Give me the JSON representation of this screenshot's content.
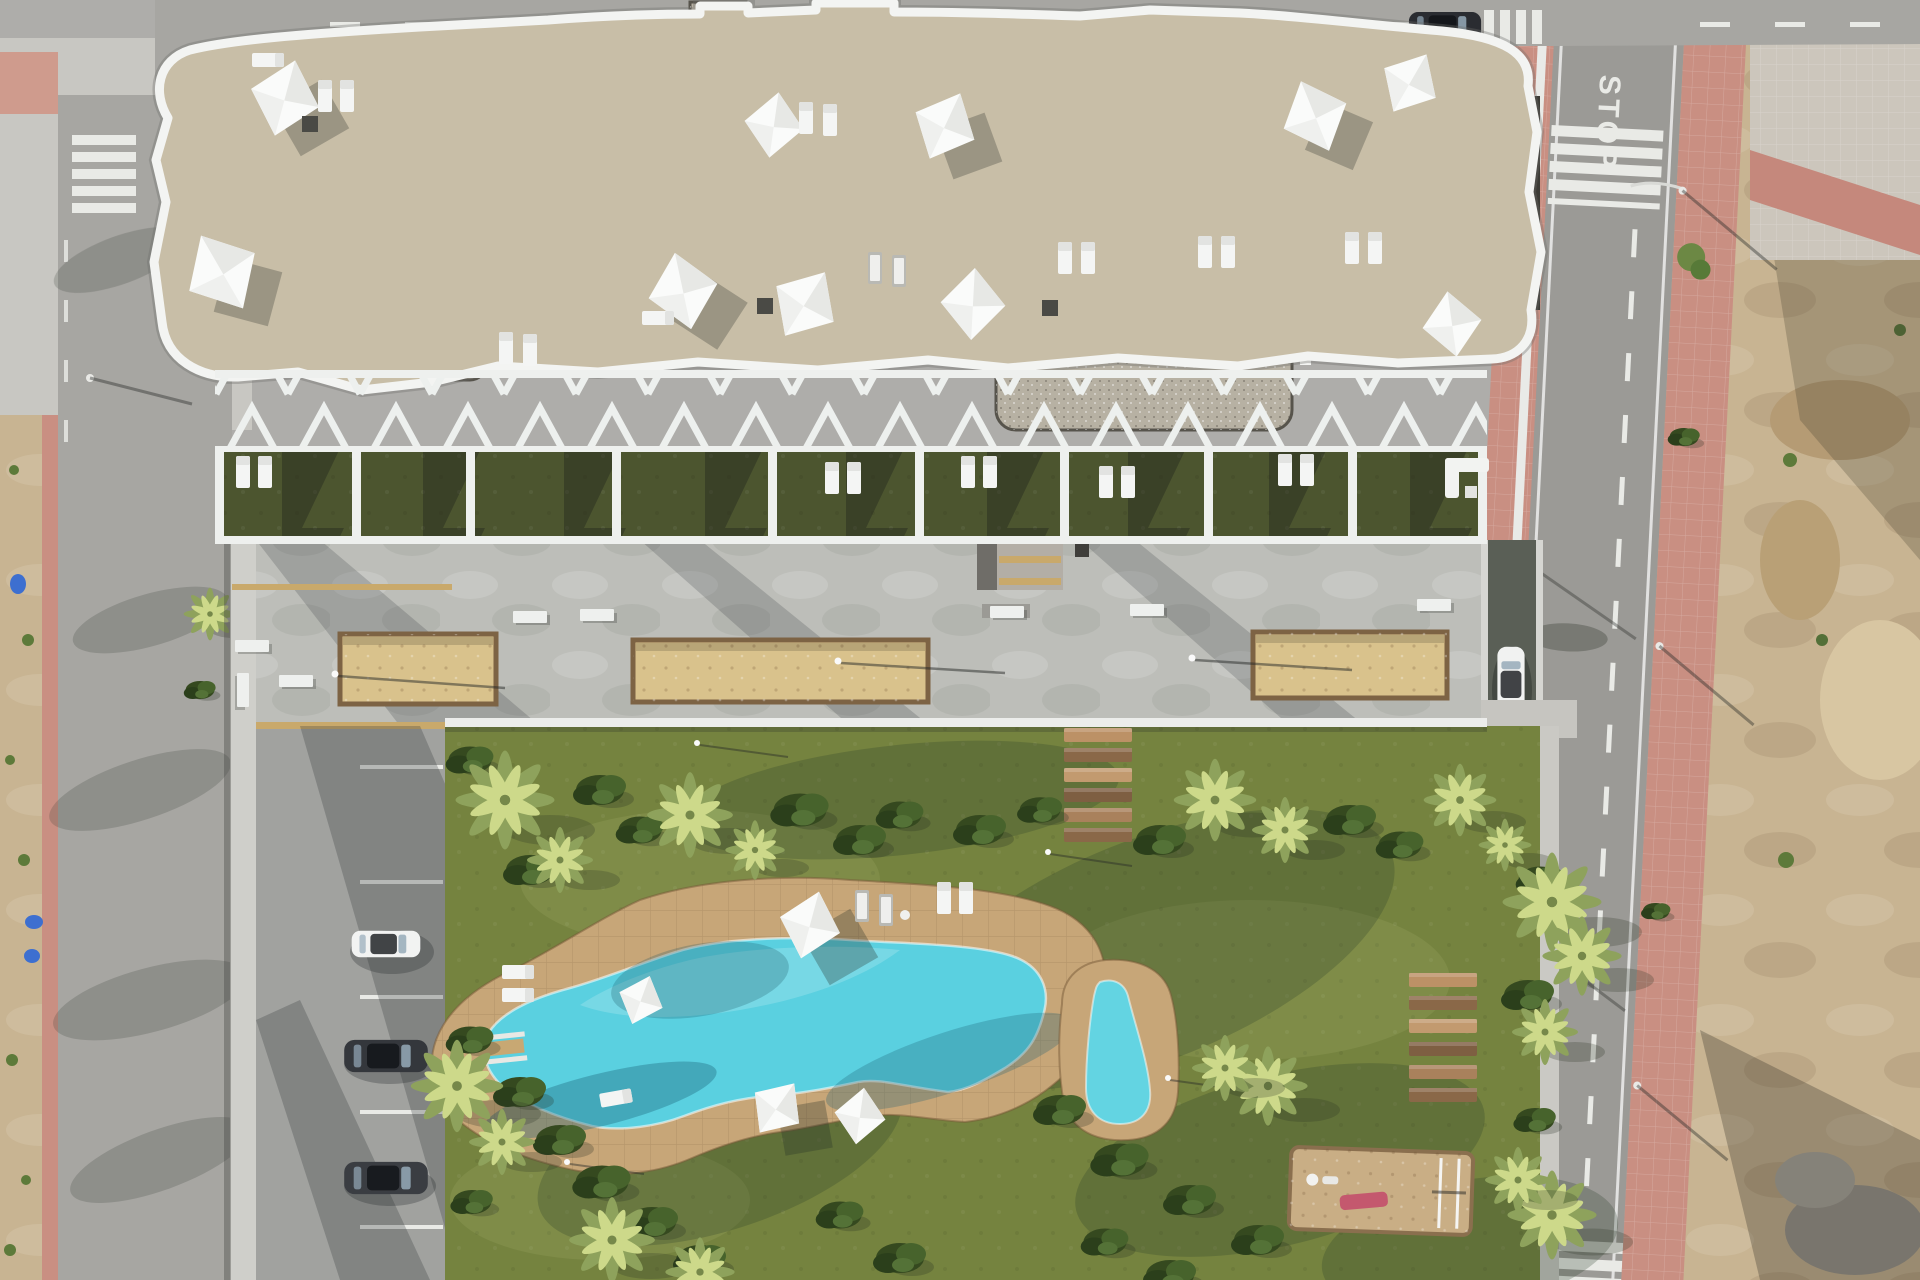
{
  "road": {
    "stop_marking": "STOP"
  },
  "colors": {
    "asphalt": "#a7a6a2",
    "asphalt_dark": "#9b9a96",
    "sidewalk_concrete": "#c8c7c2",
    "red_sidewalk": "#c98f82",
    "concrete_plaza": "#bdbeb9",
    "parking_asphalt": "#a1a29f",
    "lawn": "#75833f",
    "terrace_grass": "#4c552f",
    "pool_deck": "#c7a678",
    "pool_water": "#5ad0e0",
    "pool_water_small": "#63d4e2",
    "planter_sand": "#d9c28c",
    "dirt": "#c8b492",
    "stone_roof": "#c8bea7",
    "gravel_roof": "#b7b1a3",
    "dark_roof": "#3c3b37",
    "playground_mulch": "#c9ae85",
    "slide_pink": "#c4586e",
    "white_paint": "#f3f4f2"
  }
}
